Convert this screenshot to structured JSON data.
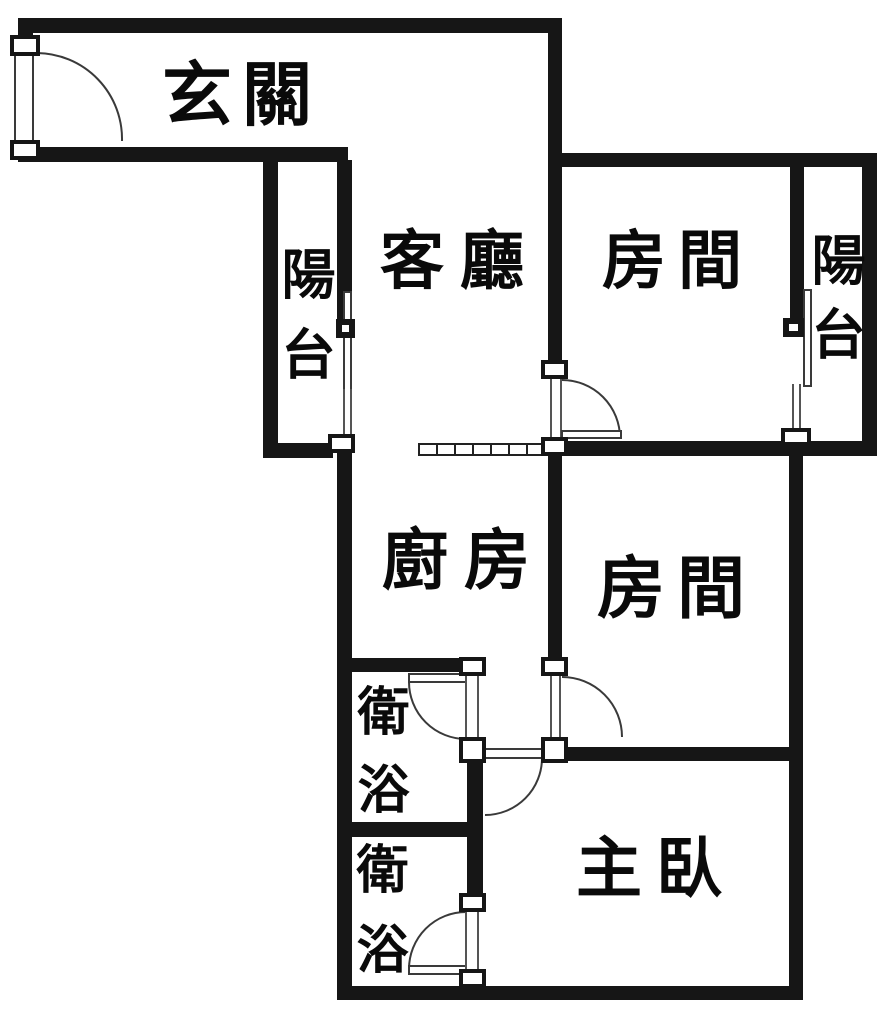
{
  "canvas": {
    "width": 889,
    "height": 1010,
    "background": "#ffffff"
  },
  "palette": {
    "wall": "#161616",
    "text": "#0a0a0a",
    "door_arc": "#3a3a3a"
  },
  "rooms": {
    "entry": {
      "label": "玄關"
    },
    "balcony_left": {
      "label": "陽台"
    },
    "living": {
      "label": "客廳"
    },
    "room_top": {
      "label": "房間"
    },
    "balcony_right": {
      "label": "陽台"
    },
    "kitchen": {
      "label": "廚房"
    },
    "room_mid": {
      "label": "房間"
    },
    "bath_upper": {
      "label": "衛浴"
    },
    "bath_lower": {
      "label": "衛浴"
    },
    "master": {
      "label": "主臥"
    }
  }
}
